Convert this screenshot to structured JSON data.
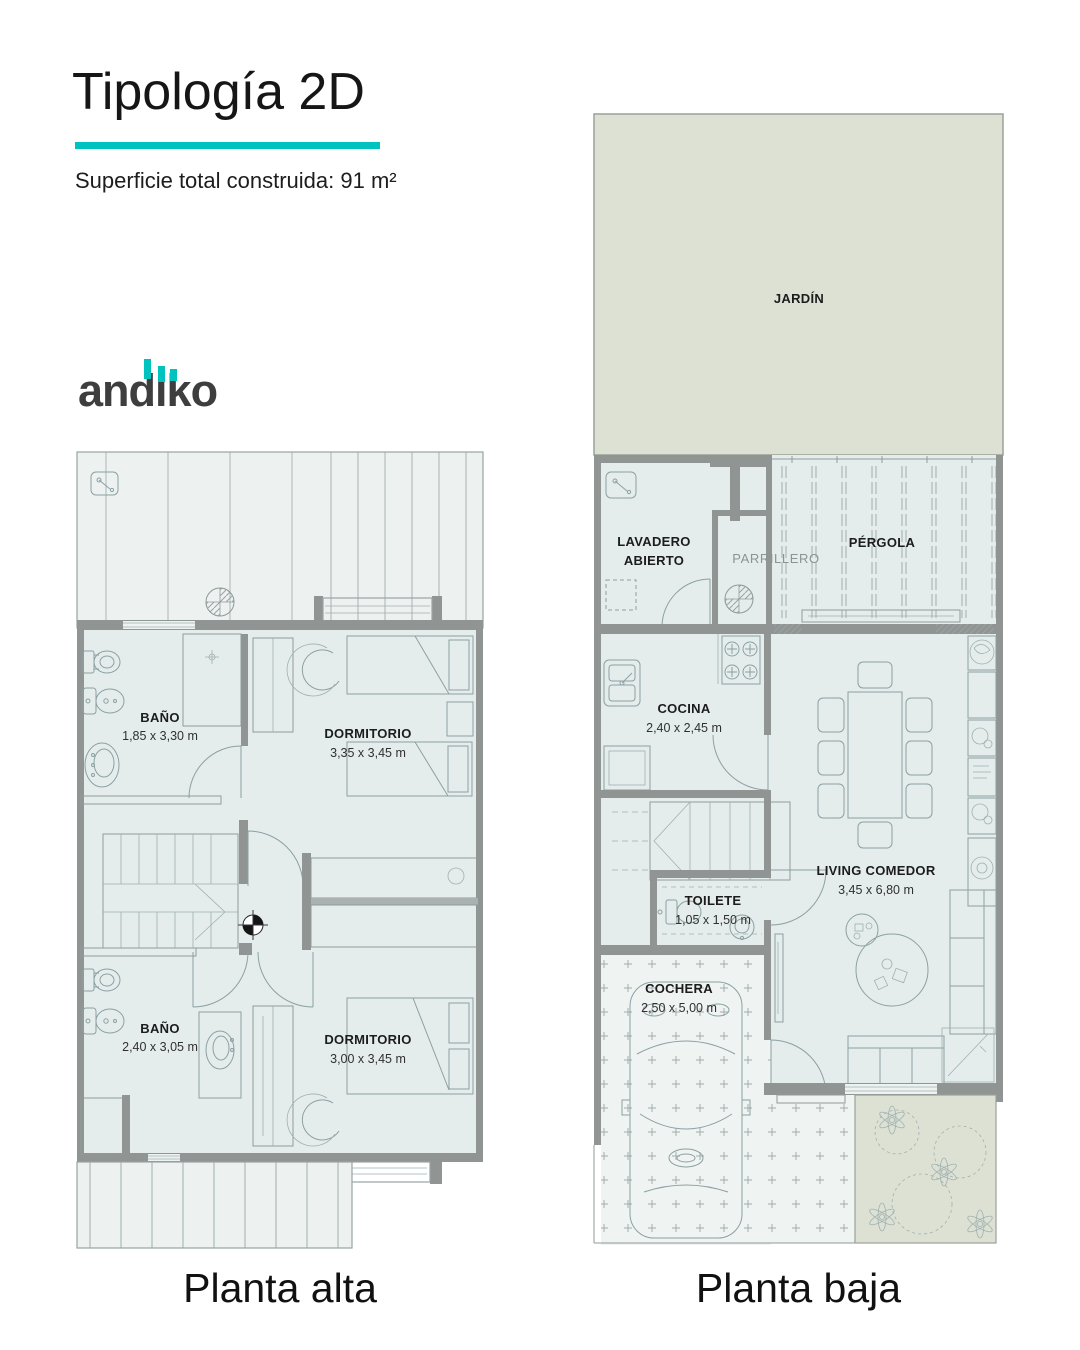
{
  "header": {
    "title": "Tipología 2D",
    "subtitle": "Superficie total construida: 91 m²"
  },
  "logo": {
    "brand": "andiko",
    "segments": {
      "an": "an",
      "d": "d",
      "i": "i",
      "k": "k",
      "o": "o"
    }
  },
  "plans": {
    "alta": {
      "caption": "Planta alta",
      "rooms": {
        "bano1": {
          "name": "BAÑO",
          "dims": "1,85 x 3,30 m"
        },
        "dorm1": {
          "name": "DORMITORIO",
          "dims": "3,35 x 3,45 m"
        },
        "bano2": {
          "name": "BAÑO",
          "dims": "2,40 x 3,05 m"
        },
        "dorm2": {
          "name": "DORMITORIO",
          "dims": "3,00 x 3,45 m"
        }
      }
    },
    "baja": {
      "caption": "Planta baja",
      "rooms": {
        "jardin": {
          "name": "JARDÍN"
        },
        "lavadero": {
          "line1": "LAVADERO",
          "line2": "ABIERTO"
        },
        "parrillero": {
          "name": "PARRILLERO"
        },
        "pergola": {
          "name": "PÉRGOLA"
        },
        "cocina": {
          "name": "COCINA",
          "dims": "2,40 x 2,45 m"
        },
        "living": {
          "name": "LIVING COMEDOR",
          "dims": "3,45 x 6,80 m"
        },
        "toilete": {
          "name": "TOILETE",
          "dims": "1,05 x 1,50 m"
        },
        "cochera": {
          "name": "COCHERA",
          "dims": "2,50 x 5,00 m"
        }
      }
    }
  },
  "colors": {
    "accent": "#00c2bf",
    "brand": "#3e3e3e",
    "interior": "#e5edec",
    "garden": "#dde1d4",
    "wall": "#909593",
    "ink": "#161616"
  }
}
